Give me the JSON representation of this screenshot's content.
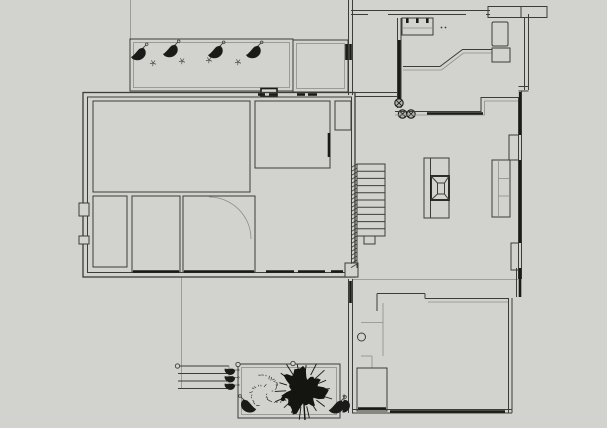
{
  "document": {
    "title": "Residential floor plan - monochrome CAD line drawing, ground floor with garden",
    "visible_text": "none"
  },
  "colors": {
    "background": "#d2d2ce",
    "line": "#3c3c38",
    "line_dark": "#1a1a18",
    "line_light": "#8e8e89",
    "foliage": "#141410",
    "post_fill": "#a9a9a5"
  },
  "features": {
    "staircase": {
      "x": 357,
      "y": 164,
      "width": 28,
      "height": 72,
      "treads": 10,
      "post": {
        "x": 364,
        "y": 236,
        "width": 11,
        "height": 8
      },
      "hatch": {
        "x": 351,
        "width": 6,
        "y1": 164,
        "y2": 268,
        "tick_count": 26
      }
    },
    "top_planter": {
      "cones": [
        [
          138,
          53
        ],
        [
          170,
          50
        ],
        [
          215,
          51
        ],
        [
          253,
          51
        ]
      ],
      "sprigs": [
        [
          153,
          63
        ],
        [
          182,
          61
        ],
        [
          209,
          60
        ],
        [
          238,
          62
        ]
      ]
    },
    "kitchen": {
      "burners": [
        [
          399,
          103
        ],
        [
          402.5,
          114
        ],
        [
          411,
          114
        ]
      ],
      "burner_radius": 4.2,
      "faucet_dots": [
        [
          441.5,
          27.5
        ],
        [
          445.5,
          27.5
        ]
      ],
      "sink_ticks": [
        406,
        416,
        426
      ]
    },
    "windows": {
      "top_y": 94.5,
      "top_segments": [
        [
          258,
          265
        ],
        [
          269,
          277
        ],
        [
          297,
          305
        ],
        [
          308,
          317
        ]
      ],
      "bottom_y": 271.5,
      "bottom_segments": [
        [
          133,
          179
        ],
        [
          184,
          254
        ],
        [
          266,
          294
        ],
        [
          298,
          325
        ],
        [
          331,
          343
        ]
      ]
    },
    "right_wall_glazing": {
      "x": 520,
      "segments": [
        [
          92,
          135
        ],
        [
          160,
          243
        ],
        [
          268,
          279
        ]
      ]
    },
    "bottom_garden": {
      "tree": {
        "cx": 303,
        "cy": 390,
        "radius": 24,
        "spikes": 18
      },
      "scatter": {
        "cx": 268,
        "cy": 391,
        "radius": 21,
        "strokes": 34
      },
      "cones": [
        {
          "x": 249,
          "y": 405,
          "flip": true
        },
        {
          "x": 336,
          "y": 406,
          "flip": false
        }
      ],
      "posts": [
        [
          177.5,
          366
        ],
        [
          238,
          364.5
        ],
        [
          293,
          363.5
        ]
      ],
      "steps": {
        "x1": 178,
        "x2": 229,
        "lines": [
          366,
          373.5,
          381,
          388.5
        ],
        "end_cones": [
          [
            230,
            370
          ],
          [
            230,
            377.5
          ],
          [
            230,
            385
          ]
        ]
      }
    }
  }
}
